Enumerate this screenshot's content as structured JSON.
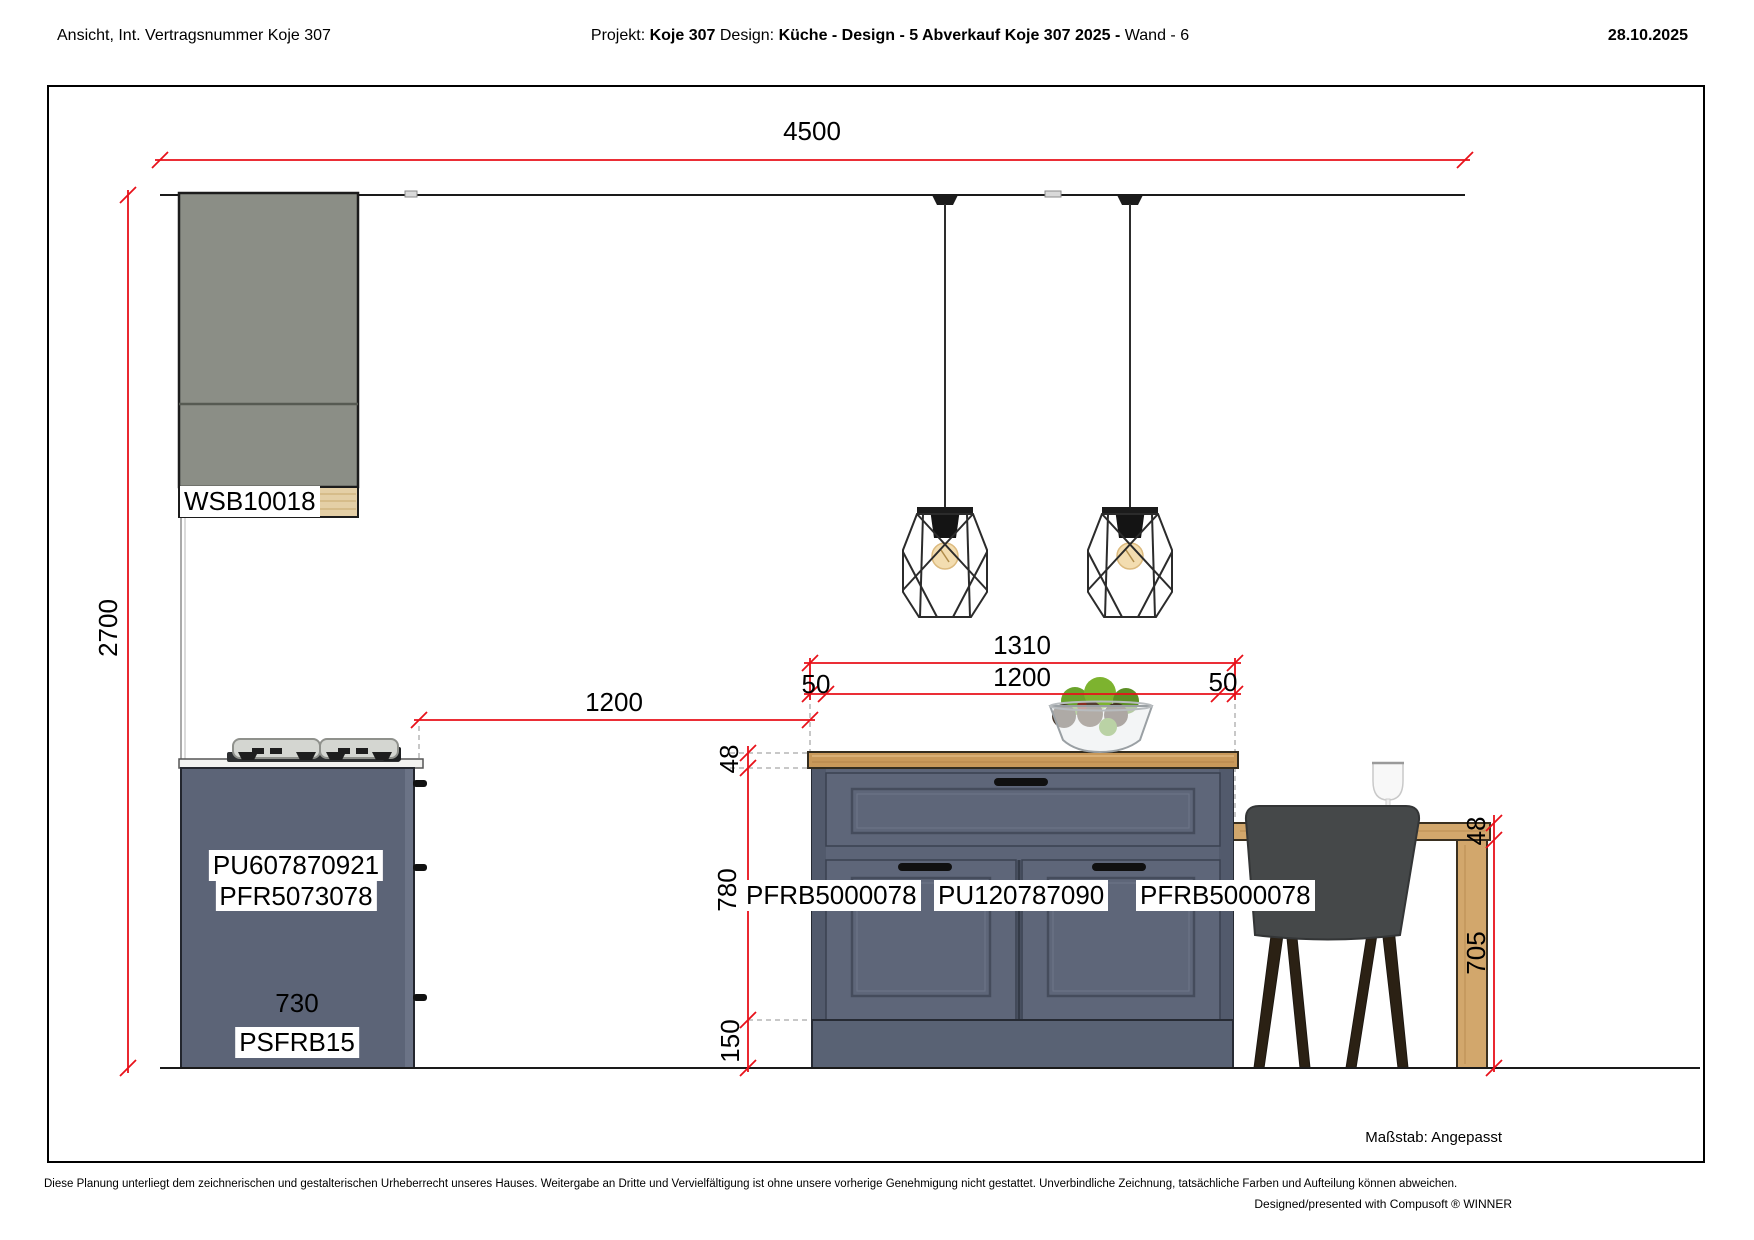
{
  "header": {
    "left": "Ansicht, Int. Vertragsnummer Koje 307",
    "project_label": "Projekt:",
    "project_value": "Koje 307",
    "design_label": "Design:",
    "design_value": "Küche - Design - 5 Abverkauf Koje 307 2025 -",
    "wall_value": "Wand - 6",
    "date": "28.10.2025"
  },
  "drawing": {
    "dims": {
      "wall_width": "4500",
      "wall_height": "2700",
      "gap_units": "1200",
      "island_total": "1310",
      "island_inner": "1200",
      "overhang_left": "50",
      "overhang_right": "50",
      "counter_thickness": "48",
      "island_front_height": "780",
      "plinth_height": "150",
      "bar_thickness": "48",
      "bar_height": "705",
      "hob_unit_width": "730"
    },
    "labels": {
      "wall_cabinet": "WSB10018",
      "hob_unit_line1": "PU607870921",
      "hob_unit_line2": "PFR5073078",
      "hob_plinth": "PSFRB15",
      "island_left": "PFRB5000078",
      "island_center": "PU120787090",
      "island_right": "PFRB5000078"
    },
    "scale_label": "Maßstab: Angepasst"
  },
  "footer": {
    "disclaimer": "Diese Planung unterliegt dem zeichnerischen und gestalterischen Urheberrecht unseres Hauses. Weitergabe an Dritte und Vervielfältigung ist ohne unsere vorherige Genehmigung nicht gestattet. Unverbindliche Zeichnung, tatsächliche Farben und Aufteilung können abweichen.",
    "credit": "Designed/presented with Compusoft ® WINNER"
  },
  "colors": {
    "dimension_red": "#e8111a",
    "cabinet_gray": "#8b8e86",
    "cabinet_blue": "#5c6477",
    "counter_wood": "#c9995a",
    "bar_wood": "#d2a76c",
    "chair_gray": "#454849"
  }
}
